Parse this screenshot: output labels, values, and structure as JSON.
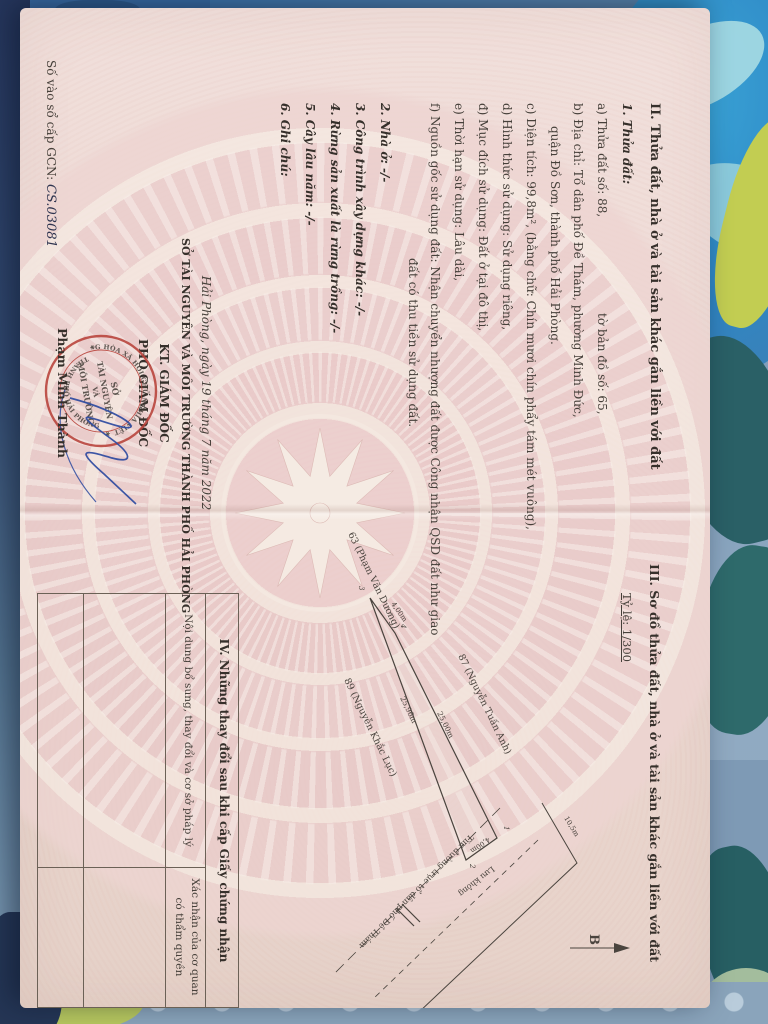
{
  "colors": {
    "paper": "#eedad5",
    "stamp_red": "#b8423a",
    "ink_blue": "#2c4aa0",
    "fabric_blue": "#2f86c4",
    "fabric_teal": "#2a6066",
    "fabric_yellow_green": "#c2cd52"
  },
  "doc": {
    "section_II": {
      "heading": "II. Thửa đất, nhà ở và tài sản khác gắn liền với đất",
      "item1_title": "1. Thửa đất:",
      "a1": "a) Thửa đất số: 88,",
      "a2": "tờ bản đồ số: 65,",
      "b1": "b) Địa chỉ: Tổ dân phố Đề Thám, phường Minh Đức,",
      "b2": "quận Đồ Sơn, thành phố Hải Phòng.",
      "c": "c) Diện tích: 99,8m², (bằng chữ: Chín mươi chín phẩy tám mét vuông),",
      "d": "d) Hình thức sử dụng: Sử dụng riêng,",
      "dd": "đ) Mục đích sử dụng: Đất ở tại đô thị,",
      "e": "e) Thời hạn sử dụng: Lâu dài,",
      "f1": "f) Nguồn gốc sử dụng đất: Nhận chuyển nhượng đất được Công nhận QSD đất như giao",
      "f2": "đất có thu tiền sử dụng đất.",
      "item2": "2. Nhà ở: -/-",
      "item3": "3. Công trình xây dựng khác: -/-",
      "item4": "4. Rừng sản xuất là rừng trồng: -/-",
      "item5": "5. Cây lâu năm: -/-",
      "item6": "6. Ghi chú:"
    },
    "signature": {
      "date_line": "Hải Phòng, ngày 19 tháng 7 năm 2022",
      "agency": "SỞ TÀI NGUYÊN VÀ MÔI TRƯỜNG THÀNH PHỐ HẢI PHÒNG",
      "kt": "KT. GIÁM ĐỐC",
      "deputy": "PHÓ GIÁM ĐỐC",
      "signer": "Phạm Minh Thành",
      "stamp_ring_top": "CỘNG HÒA XÃ HỘI CHỦ NGHĨA VIỆT NAM",
      "stamp_ring_bottom": "THÀNH PHỐ HẢI PHÒNG",
      "stamp_center_1": "SỞ",
      "stamp_center_2": "TÀI NGUYÊN",
      "stamp_center_3": "VÀ",
      "stamp_center_4": "MÔI TRƯỜNG"
    },
    "gcn": {
      "label": "Số vào sổ cấp GCN:",
      "value": "CS.03081"
    },
    "section_III": {
      "heading": "III. Sơ đồ thửa đất, nhà ở và tài sản khác gắn liền với đất",
      "scale": "Tỷ lệ: 1/300",
      "north_label": "B",
      "neighbor_top": "87 (Nguyễn Tuấn Anh)",
      "neighbor_bottom": "89 (Nguyễn Khắc Lục)",
      "neighbor_left": "63 (Phạm Văn Dương)",
      "dim_top": "25,00m",
      "dim_bottom": "25,96m",
      "dim_left_end": "4,00m",
      "dim_right_end": "4,00m",
      "dim_road": "10,5m",
      "vertex_1": "1",
      "vertex_2": "2",
      "vertex_3": "3",
      "vertex_4": "4",
      "reserve_label": "Lưu không",
      "road_label": "Tim đường trục tổ dân phố Đề Thám"
    },
    "section_IV": {
      "heading": "IV. Những thay đổi sau khi cấp Giấy chứng nhận",
      "col1": "Nội dung bổ sung, thay đổi và cơ sở pháp lý",
      "col2_line1": "Xác nhận của cơ quan",
      "col2_line2": "có thẩm quyền"
    }
  }
}
